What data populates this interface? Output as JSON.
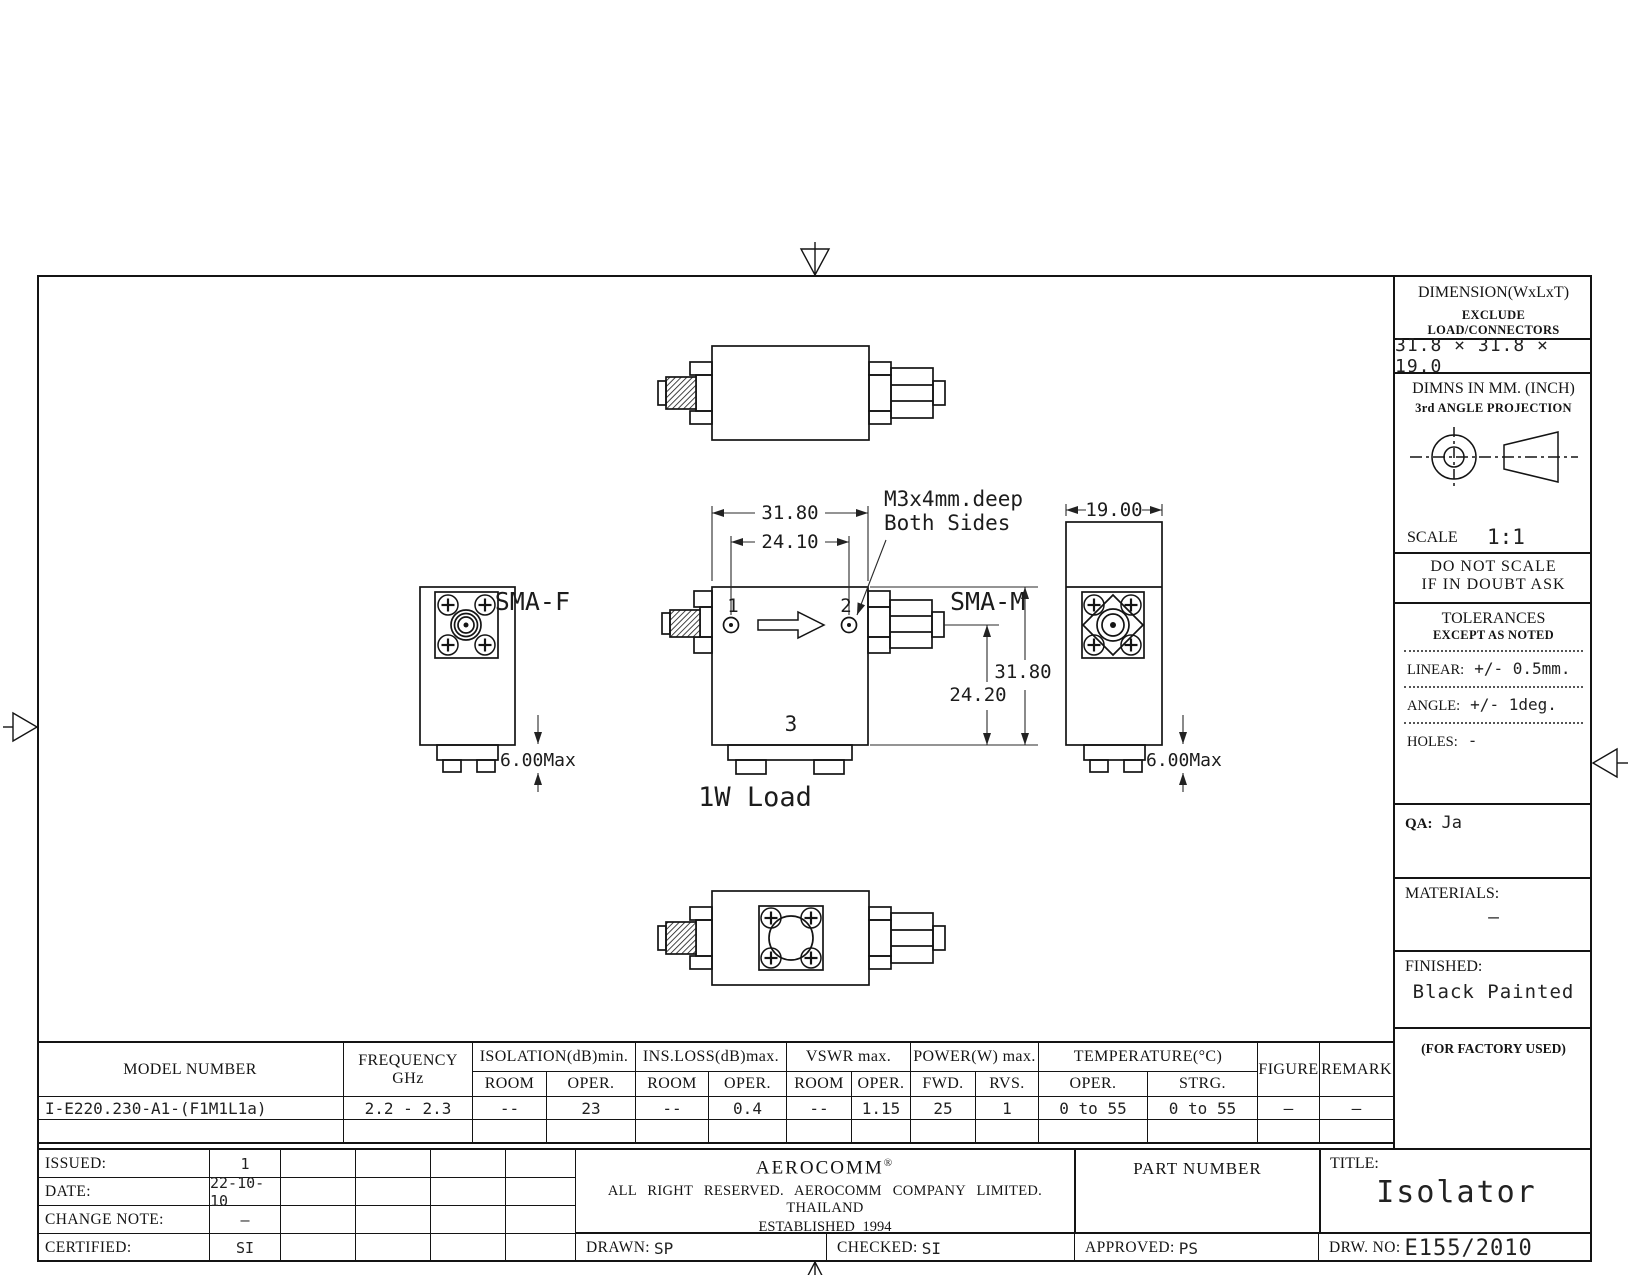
{
  "drawing": {
    "labels": {
      "sma_f": "SMA-F",
      "sma_m": "SMA-M",
      "port_1": "1",
      "port_2": "2",
      "port_3": "3",
      "load": "1W Load",
      "note_line1": "M3x4mm.deep",
      "note_line2": "Both Sides"
    },
    "dims": {
      "body_width": "31.80",
      "hole_spacing": "24.10",
      "body_depth": "19.00",
      "port_height": "24.20",
      "body_height": "31.80",
      "tab_left": "6.00Max",
      "tab_right": "6.00Max"
    }
  },
  "info_panel": {
    "dimension_title": "DIMENSION(WxLxT)",
    "dimension_note": "EXCLUDE LOAD/CONNECTORS",
    "dimension_value": "31.8 × 31.8 × 19.0",
    "units_line": "DIMNS IN MM. (INCH)",
    "projection_line": "3rd ANGLE PROJECTION",
    "scale_label": "SCALE",
    "scale_value": "1:1",
    "warning_line1": "DO NOT SCALE",
    "warning_line2": "IF IN DOUBT ASK",
    "tolerances_title": "TOLERANCES",
    "tolerances_note": "EXCEPT AS NOTED",
    "linear_label": "LINEAR:",
    "linear_value": "+/- 0.5mm.",
    "angle_label": "ANGLE:",
    "angle_value": "+/- 1deg.",
    "holes_label": "HOLES:",
    "holes_value": "-",
    "qa_label": "QA:",
    "qa_value": "Ja",
    "materials_label": "MATERIALS:",
    "materials_value": "–",
    "finished_label": "FINISHED:",
    "finished_value": "Black Painted",
    "factory_note": "(FOR FACTORY USED)"
  },
  "spec_table": {
    "headers": {
      "model": "MODEL NUMBER",
      "frequency_line1": "FREQUENCY",
      "frequency_line2": "GHz",
      "isolation": "ISOLATION(dB)min.",
      "ins_loss": "INS.LOSS(dB)max.",
      "vswr": "VSWR max.",
      "power": "POWER(W) max.",
      "temperature": "TEMPERATURE(°C)",
      "figure": "FIGURE",
      "remark": "REMARK",
      "sub": [
        "ROOM",
        "OPER.",
        "ROOM",
        "OPER.",
        "ROOM",
        "OPER.",
        "FWD.",
        "RVS.",
        "OPER.",
        "STRG."
      ]
    },
    "row": {
      "model": "I-E220.230-A1-(F1M1L1a)",
      "frequency": "2.2 - 2.3",
      "values": [
        "--",
        "23",
        "--",
        "0.4",
        "--",
        "1.15",
        "25",
        "1",
        "0 to 55",
        "0 to 55",
        "—",
        "—"
      ]
    }
  },
  "title_block": {
    "issued_label": "ISSUED:",
    "issued_value": "1",
    "date_label": "DATE:",
    "date_value": "22-10-10",
    "change_label": "CHANGE NOTE:",
    "change_value": "–",
    "certified_label": "CERTIFIED:",
    "certified_value": "SI",
    "company": "AEROCOMM",
    "registered_mark": "®",
    "rights": "ALL RIGHT RESERVED. AEROCOMM COMPANY LIMITED. THAILAND",
    "established": "ESTABLISHED 1994",
    "part_number_label": "PART NUMBER",
    "title_label": "TITLE:",
    "title_value": "Isolator",
    "drawn_label": "DRAWN:",
    "drawn_value": "SP",
    "checked_label": "CHECKED:",
    "checked_value": "SI",
    "approved_label": "APPROVED:",
    "approved_value": "PS",
    "drw_no_label": "DRW. NO:",
    "drw_no_value": "E155/2010"
  }
}
